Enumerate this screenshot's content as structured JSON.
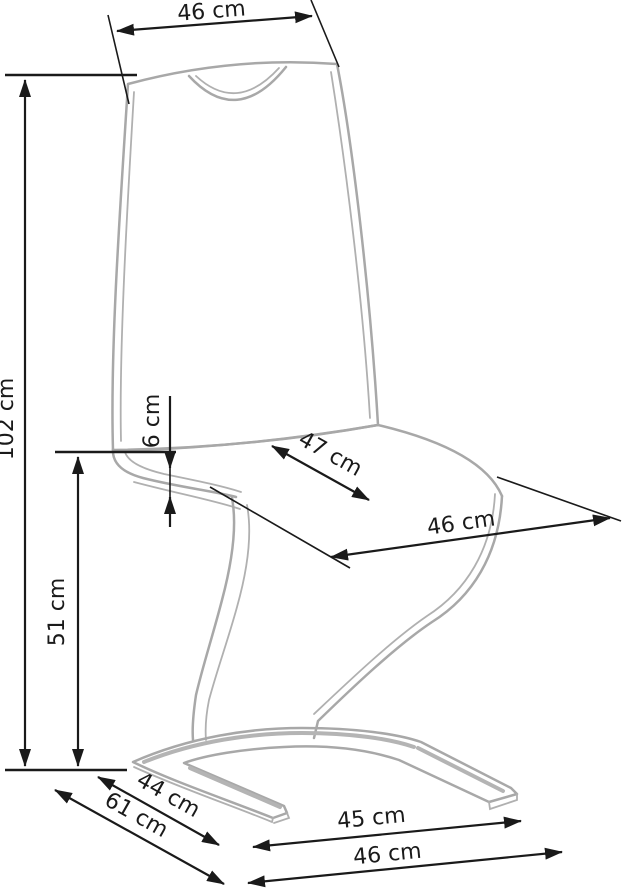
{
  "diagram": {
    "type": "furniture-dimension-diagram",
    "subject": "cantilever chair with quilted backrest",
    "unit": "cm",
    "dimensions": {
      "back_width": {
        "label": "46 cm",
        "value": 46
      },
      "total_height": {
        "label": "102 cm",
        "value": 102
      },
      "seat_thickness": {
        "label": "6 cm",
        "value": 6
      },
      "seat_depth": {
        "label": "47 cm",
        "value": 47
      },
      "seat_width": {
        "label": "46 cm",
        "value": 46
      },
      "seat_height": {
        "label": "51 cm",
        "value": 51
      },
      "base_leg_length": {
        "label": "44 cm",
        "value": 44
      },
      "base_depth": {
        "label": "61 cm",
        "value": 61
      },
      "base_front_width": {
        "label": "45 cm",
        "value": 45
      },
      "base_total_width": {
        "label": "46 cm",
        "value": 46
      }
    },
    "colors": {
      "chair_outline": "#a8a8a8",
      "dimension_lines": "#1a1a1a",
      "background": "#ffffff"
    }
  }
}
